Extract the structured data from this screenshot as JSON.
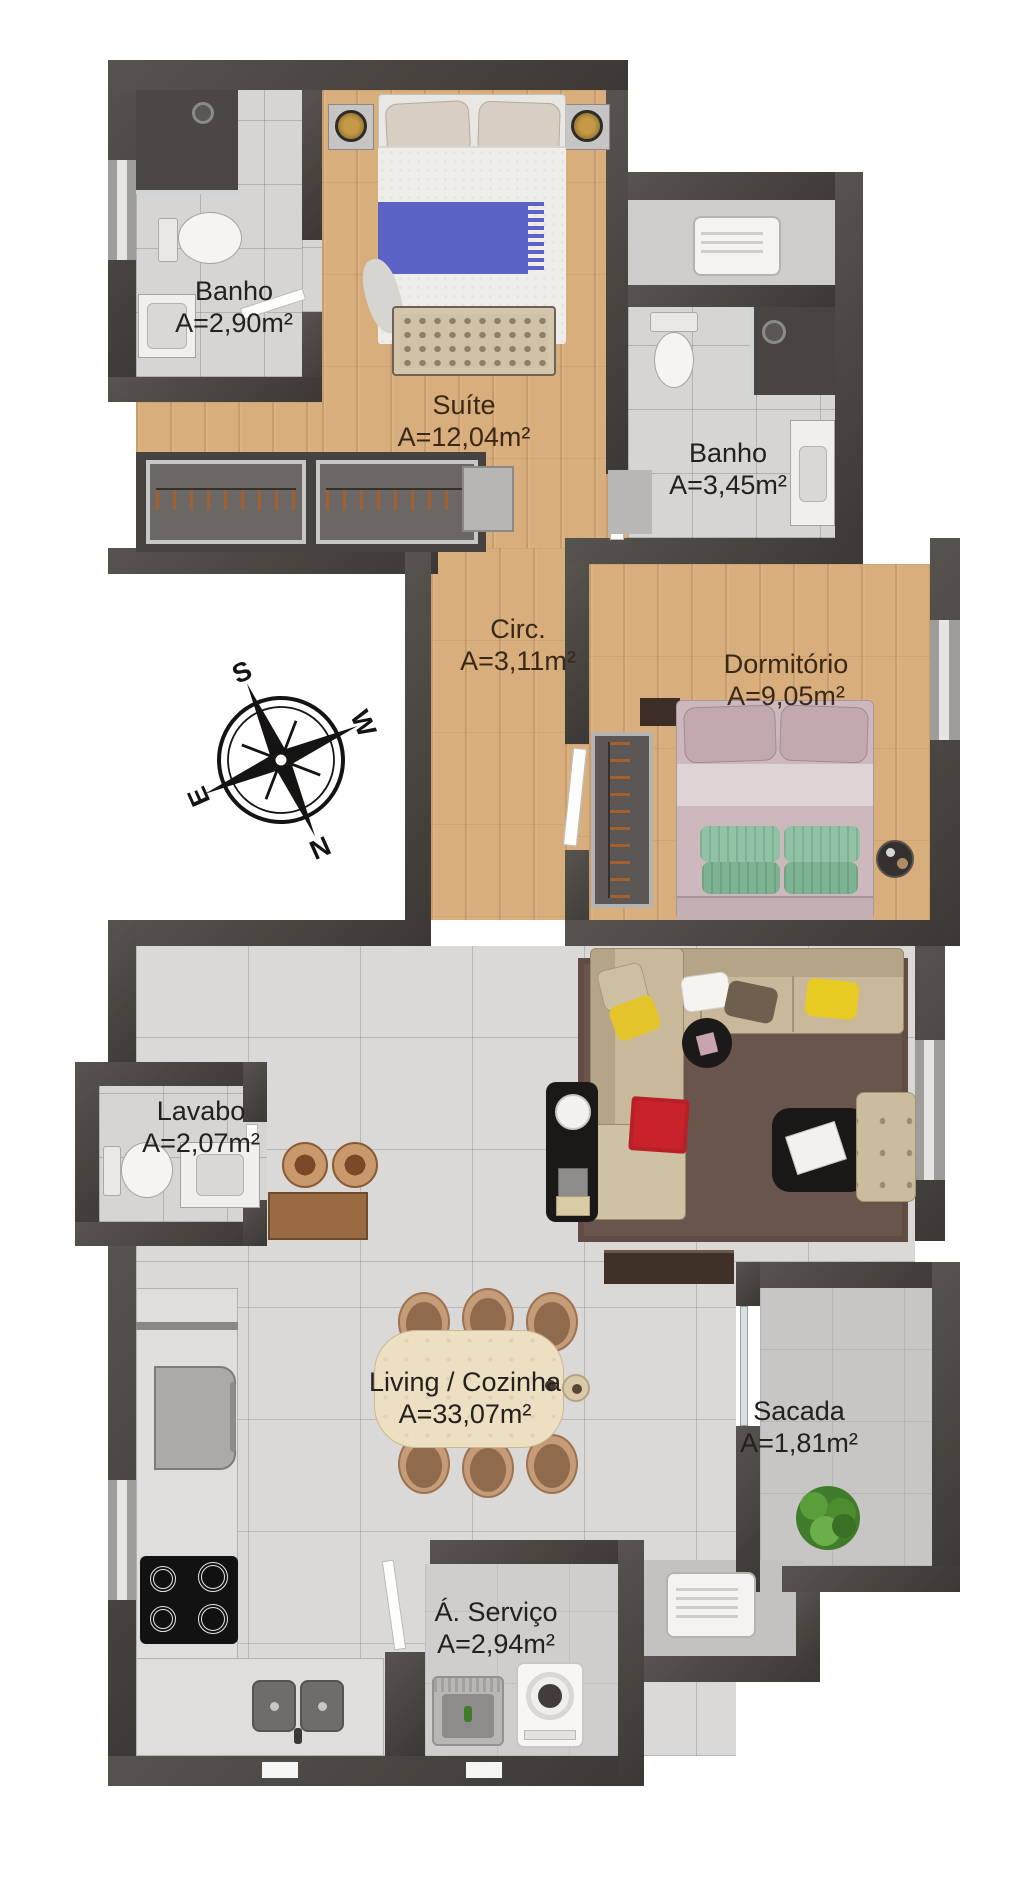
{
  "plan": {
    "rooms": [
      {
        "id": "banho-suite",
        "name": "Banho",
        "area": "A=2,90m²"
      },
      {
        "id": "suite",
        "name": "Suíte",
        "area": "A=12,04m²"
      },
      {
        "id": "banho-social",
        "name": "Banho",
        "area": "A=3,45m²"
      },
      {
        "id": "circulacao",
        "name": "Circ.",
        "area": "A=3,11m²"
      },
      {
        "id": "dormitorio",
        "name": "Dormitório",
        "area": "A=9,05m²"
      },
      {
        "id": "lavabo",
        "name": "Lavabo",
        "area": "A=2,07m²"
      },
      {
        "id": "living",
        "name": "Living / Cozinha",
        "area": "A=33,07m²"
      },
      {
        "id": "sacada",
        "name": "Sacada",
        "area": "A=1,81m²"
      },
      {
        "id": "servico",
        "name": "Á. Serviço",
        "area": "A=2,94m²"
      }
    ],
    "compass": {
      "south": "S",
      "west": "W",
      "north": "N",
      "east": "E"
    },
    "colors": {
      "wall": "#48443f",
      "wood_floor": "#d9ae7d",
      "tile_floor": "#d7d5d3",
      "living_floor": "#dbd9d7",
      "balcony_floor": "#c8c6c4",
      "rug": "#6a554c",
      "sofa": "#c9b99a",
      "blanket_blue": "#5b64c6",
      "throw_red": "#c8232b",
      "pillow_yellow": "#e8cb22",
      "pillow_green": "#8fc3a4",
      "bed_mauve": "#cdb9bd",
      "plant_green": "#4d8c2f"
    }
  }
}
